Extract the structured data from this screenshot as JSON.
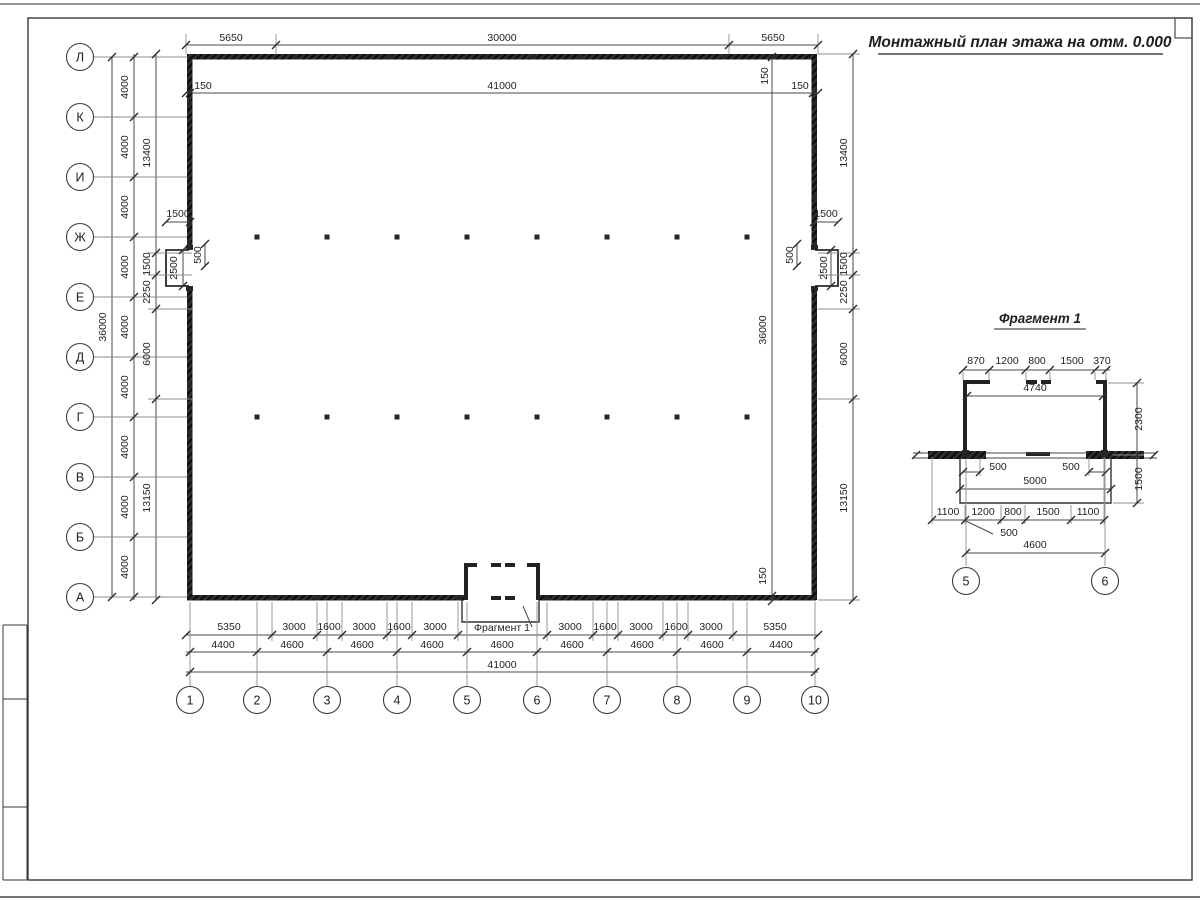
{
  "sheet": {
    "title": "Монтажный план этажа на отм. 0.000"
  },
  "plan": {
    "axes_rows": [
      "Л",
      "К",
      "И",
      "Ж",
      "Е",
      "Д",
      "Г",
      "В",
      "Б",
      "А"
    ],
    "axes_cols": [
      "1",
      "2",
      "3",
      "4",
      "5",
      "6",
      "7",
      "8",
      "9",
      "10"
    ],
    "dims_top_row1": [
      "5650",
      "30000",
      "5650"
    ],
    "dims_top_row2": [
      "150",
      "41000",
      "150"
    ],
    "dim_top_150_vert": "150",
    "dims_left_spacing": [
      "4000",
      "4000",
      "4000",
      "4000",
      "4000",
      "4000",
      "4000",
      "4000",
      "4000"
    ],
    "dims_left_groups": [
      "13400",
      "1500",
      "2250",
      "6000",
      "13150"
    ],
    "dim_left_total": "36000",
    "dims_right_groups": [
      "13400",
      "1500",
      "2250",
      "6000",
      "13150"
    ],
    "dim_right_inner_total": "36000",
    "dim_right_inner_150": "150",
    "niche_left": {
      "w": "1500",
      "h": "2500",
      "jamb": "500"
    },
    "niche_right": {
      "w": "1500",
      "h": "2500",
      "jamb": "500"
    },
    "dims_bottom_row1_left": [
      "5350",
      "3000",
      "1600",
      "3000",
      "1600",
      "3000"
    ],
    "fragment_callout": "Фрагмент 1",
    "dims_bottom_row1_right": [
      "3000",
      "1600",
      "3000",
      "1600",
      "3000",
      "5350"
    ],
    "dims_bottom_row2": [
      "4400",
      "4600",
      "4600",
      "4600",
      "4600",
      "4600",
      "4600",
      "4600",
      "4400"
    ],
    "dim_bottom_total": "41000"
  },
  "fragment": {
    "title": "Фрагмент 1",
    "axes": [
      "5",
      "6"
    ],
    "dims_top": [
      "870",
      "1200",
      "800",
      "1500",
      "370"
    ],
    "dim_inner_width": "4740",
    "dim_height": "2300",
    "dim_jamb_left": "500",
    "dim_jamb_right": "500",
    "dim_porch_width": "5000",
    "dim_porch_depth": "1500",
    "dims_bottom": [
      "1100",
      "1200",
      "800",
      "1500",
      "1100"
    ],
    "dim_offset": "500",
    "dim_axes_span": "4600"
  }
}
